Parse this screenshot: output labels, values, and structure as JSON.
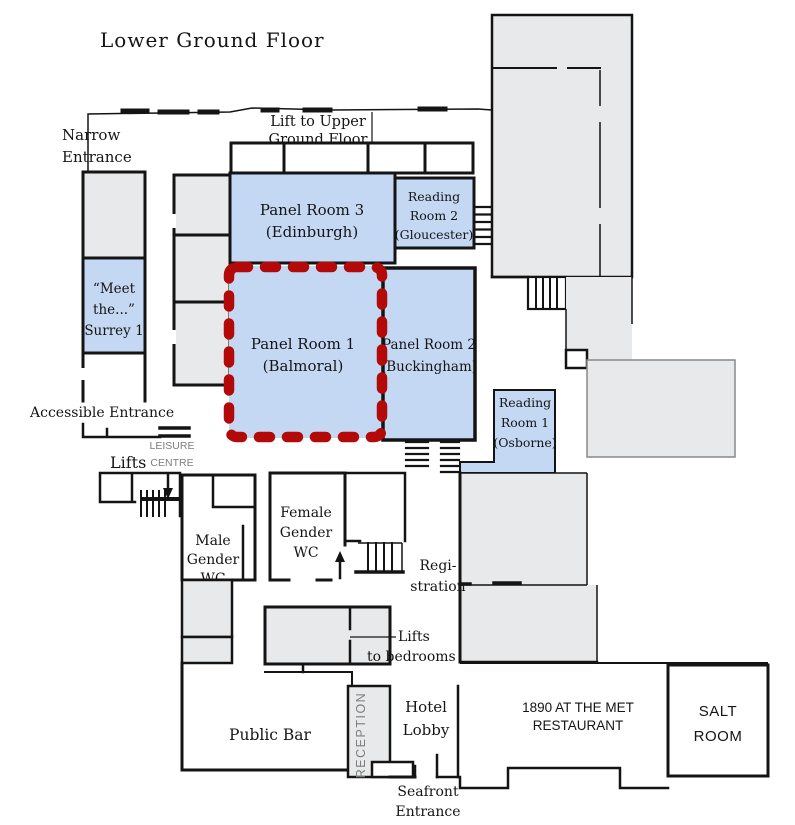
{
  "title": "Lower Ground Floor",
  "colors": {
    "room_blue": "#c5d8f3",
    "room_gray": "#e8e9ea",
    "highlight_red": "#b40909",
    "wall": "#141414",
    "label_gray": "#7d7d7d"
  },
  "rooms": {
    "narrow_entrance": [
      "Narrow",
      "Entrance"
    ],
    "lift_upper": [
      "Lift to Upper",
      "Ground Floor"
    ],
    "panel_room_3": [
      "Panel Room 3",
      "(Edinburgh)"
    ],
    "reading_room_2": [
      "Reading",
      "Room 2",
      "(Gloucester)"
    ],
    "surrey_1": [
      "“Meet",
      "the...”",
      "Surrey 1"
    ],
    "panel_room_1": [
      "Panel Room 1",
      "(Balmoral)"
    ],
    "panel_room_2": [
      "Panel Room 2",
      "(Buckingham)"
    ],
    "reading_room_1": [
      "Reading",
      "Room 1",
      "(Osborne)"
    ],
    "accessible_entrance": "Accessible Entrance",
    "lifts": "Lifts",
    "leisure_centre": [
      "LEISURE",
      "CENTRE"
    ],
    "male_wc": [
      "Male",
      "Gender",
      "WC"
    ],
    "female_wc": [
      "Female",
      "Gender",
      "WC"
    ],
    "registration": [
      "Regi-",
      "stration"
    ],
    "lifts_to_bedrooms": [
      "Lifts",
      "to bedrooms"
    ],
    "public_bar": "Public Bar",
    "reception": "RECEPTION",
    "hotel_lobby": [
      "Hotel",
      "Lobby"
    ],
    "restaurant": [
      "1890 AT THE MET",
      "RESTAURANT"
    ],
    "salt_room": [
      "SALT",
      "ROOM"
    ],
    "seafront_entrance": [
      "Seafront",
      "Entrance"
    ]
  }
}
